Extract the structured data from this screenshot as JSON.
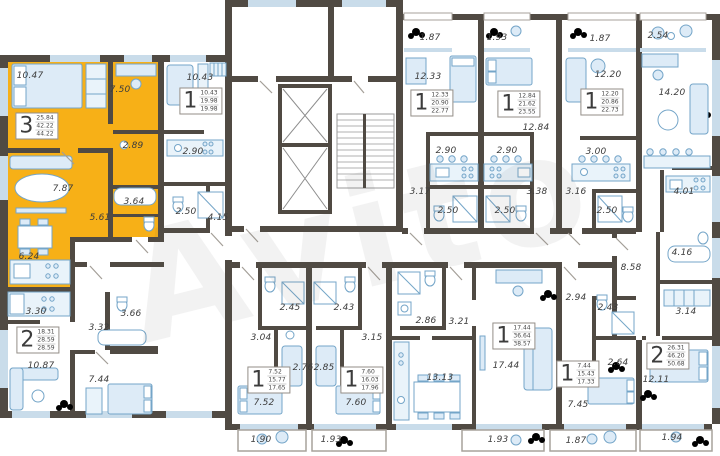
{
  "watermark": "Avito",
  "colors": {
    "highlight_yellow": "#f7b017",
    "wall": "#504a43",
    "furniture_blue": "#ddebf7",
    "furniture_stroke": "#74a5c8",
    "label_text": "#3d3d3d"
  },
  "core": {
    "elevator_count": 2,
    "has_stairwell": true
  },
  "apartments": [
    {
      "digit": "3",
      "areas": [
        "25.84",
        "42.22",
        "44.22"
      ],
      "x": 37,
      "y": 126,
      "highlighted": true
    },
    {
      "digit": "2",
      "areas": [
        "18.31",
        "28.59",
        "28.59"
      ],
      "x": 38,
      "y": 340,
      "highlighted": false
    },
    {
      "digit": "1",
      "areas": [
        "10.43",
        "19.98",
        "19.98"
      ],
      "x": 201,
      "y": 101,
      "highlighted": false
    },
    {
      "digit": "1",
      "areas": [
        "12.33",
        "20.90",
        "22.77"
      ],
      "x": 432,
      "y": 103,
      "highlighted": false
    },
    {
      "digit": "1",
      "areas": [
        "12.84",
        "21.62",
        "23.55"
      ],
      "x": 519,
      "y": 104,
      "highlighted": false
    },
    {
      "digit": "1",
      "areas": [
        "12.20",
        "20.86",
        "22.73"
      ],
      "x": 602,
      "y": 102,
      "highlighted": false
    },
    {
      "digit": "2",
      "areas": [
        "26.31",
        "46.20",
        "50.68"
      ],
      "x": 668,
      "y": 356,
      "highlighted": false
    },
    {
      "digit": "1",
      "areas": [
        "7.44",
        "15.43",
        "17.33"
      ],
      "x": 578,
      "y": 374,
      "highlighted": false
    },
    {
      "digit": "1",
      "areas": [
        "17.44",
        "36.64",
        "38.57"
      ],
      "x": 514,
      "y": 336,
      "highlighted": false
    },
    {
      "digit": "1",
      "areas": [
        "7.60",
        "16.03",
        "17.96"
      ],
      "x": 362,
      "y": 380,
      "highlighted": false
    },
    {
      "digit": "1",
      "areas": [
        "7.52",
        "15.77",
        "17.65"
      ],
      "x": 269,
      "y": 380,
      "highlighted": false
    }
  ],
  "room_labels": [
    {
      "t": "10.47",
      "x": 30,
      "y": 76
    },
    {
      "t": "7.50",
      "x": 120,
      "y": 90
    },
    {
      "t": "2.89",
      "x": 133,
      "y": 146
    },
    {
      "t": "7.87",
      "x": 63,
      "y": 189
    },
    {
      "t": "3.64",
      "x": 134,
      "y": 202
    },
    {
      "t": "5.61",
      "x": 100,
      "y": 218
    },
    {
      "t": "6.24",
      "x": 29,
      "y": 257
    },
    {
      "t": "3.30",
      "x": 36,
      "y": 312
    },
    {
      "t": "3.66",
      "x": 131,
      "y": 314
    },
    {
      "t": "3.32",
      "x": 99,
      "y": 328
    },
    {
      "t": "10.87",
      "x": 41,
      "y": 366
    },
    {
      "t": "7.44",
      "x": 99,
      "y": 380
    },
    {
      "t": "10.43",
      "x": 200,
      "y": 78
    },
    {
      "t": "2.90",
      "x": 193,
      "y": 152
    },
    {
      "t": "2.50",
      "x": 186,
      "y": 212
    },
    {
      "t": "4.15",
      "x": 218,
      "y": 218
    },
    {
      "t": "1.87",
      "x": 430,
      "y": 38
    },
    {
      "t": "12.33",
      "x": 428,
      "y": 77
    },
    {
      "t": "2.90",
      "x": 446,
      "y": 151
    },
    {
      "t": "3.17",
      "x": 420,
      "y": 192
    },
    {
      "t": "2.50",
      "x": 448,
      "y": 211
    },
    {
      "t": "1.93",
      "x": 497,
      "y": 38
    },
    {
      "t": "12.84",
      "x": 536,
      "y": 128
    },
    {
      "t": "2.90",
      "x": 507,
      "y": 151
    },
    {
      "t": "3.38",
      "x": 537,
      "y": 192
    },
    {
      "t": "2.50",
      "x": 505,
      "y": 211
    },
    {
      "t": "1.87",
      "x": 600,
      "y": 39
    },
    {
      "t": "12.20",
      "x": 608,
      "y": 75
    },
    {
      "t": "3.00",
      "x": 596,
      "y": 152
    },
    {
      "t": "3.16",
      "x": 576,
      "y": 192
    },
    {
      "t": "2.50",
      "x": 607,
      "y": 211
    },
    {
      "t": "2.54",
      "x": 658,
      "y": 36
    },
    {
      "t": "14.20",
      "x": 672,
      "y": 93
    },
    {
      "t": "4.01",
      "x": 684,
      "y": 192
    },
    {
      "t": "4.16",
      "x": 682,
      "y": 253
    },
    {
      "t": "8.58",
      "x": 631,
      "y": 268
    },
    {
      "t": "3.14",
      "x": 686,
      "y": 312
    },
    {
      "t": "12.11",
      "x": 656,
      "y": 380
    },
    {
      "t": "1.94",
      "x": 672,
      "y": 438
    },
    {
      "t": "2.45",
      "x": 290,
      "y": 308
    },
    {
      "t": "3.04",
      "x": 261,
      "y": 338
    },
    {
      "t": "2.76",
      "x": 303,
      "y": 368
    },
    {
      "t": "7.52",
      "x": 264,
      "y": 403
    },
    {
      "t": "1.90",
      "x": 261,
      "y": 440
    },
    {
      "t": "2.43",
      "x": 344,
      "y": 308
    },
    {
      "t": "3.15",
      "x": 372,
      "y": 338
    },
    {
      "t": "2.85",
      "x": 324,
      "y": 368
    },
    {
      "t": "7.60",
      "x": 356,
      "y": 403
    },
    {
      "t": "1.93",
      "x": 331,
      "y": 440
    },
    {
      "t": "2.86",
      "x": 426,
      "y": 321
    },
    {
      "t": "3.21",
      "x": 459,
      "y": 322
    },
    {
      "t": "13.13",
      "x": 440,
      "y": 378
    },
    {
      "t": "17.44",
      "x": 506,
      "y": 366
    },
    {
      "t": "1.93",
      "x": 498,
      "y": 440
    },
    {
      "t": "2.94",
      "x": 576,
      "y": 298
    },
    {
      "t": "2.43",
      "x": 608,
      "y": 308
    },
    {
      "t": "2.64",
      "x": 618,
      "y": 363
    },
    {
      "t": "7.45",
      "x": 578,
      "y": 405
    },
    {
      "t": "1.87",
      "x": 576,
      "y": 441
    }
  ]
}
